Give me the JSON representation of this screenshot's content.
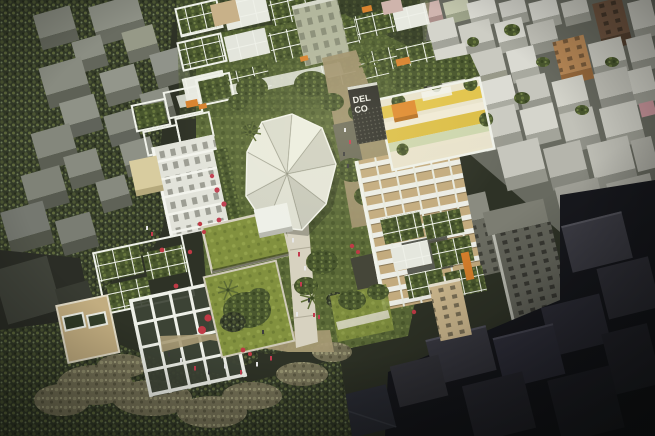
{
  "meta": {
    "title": "Aerial 3D architectural rendering of a green courtyard housing development surrounded by city-block massing",
    "type": "architectural-render",
    "width": 655,
    "height": 436
  },
  "signage": {
    "line1": "DEL",
    "line2": "CO",
    "location": "dark wall of east mid-rise building",
    "text_color": "#f0f0e8",
    "background_color": "#30302a"
  },
  "palette": {
    "ground_base": "#2e3226",
    "foliage_dark": "#333a28",
    "foliage_olive": "#49572e",
    "foliage_pale": "#767257",
    "courtyard_grass": "#5a6937",
    "bright_lawn": "#82913f",
    "massing_roof": "#8b8e83",
    "massing_wall": "#60635a",
    "context_white": "#d7d7cf",
    "dark_massing": "#26262c",
    "frame_white": "#eff1e9",
    "canopy_white": "#e2e3d7",
    "path_tan": "#a1946f",
    "walkway_light": "#d7d2c0",
    "accent_orange": "#d8832f",
    "accent_yellow": "#e2c44c",
    "accent_red": "#bf3a45",
    "facade_tan": "#c3ab7e",
    "facade_cream": "#d8cc9f",
    "context_pink": "#d0b5af",
    "context_brown": "#6f5440",
    "context_orange_tan": "#b98957"
  },
  "scene": {
    "description": "High-angle view of a block-scale redevelopment: white scaffolding-like frames over green roof terraces, a faceted white fabric canopy above a central garden courtyard, bright raised lawns, a light pedestrian walkway with people, an east tower with yellow-striped roof deck and tan balcony facade bearing dark signage, all set inside monochrome gray context buildings that fade to near-black at the lower right.",
    "regions": [
      {
        "name": "context-massing-left",
        "description": "Light gray abstract building volumes over dark olive trees, upper left"
      },
      {
        "name": "context-city-top-right",
        "description": "White and gray city buildings with a pink, a brown and an orange-tan facade"
      },
      {
        "name": "context-massing-dark",
        "description": "Very dark gray building volumes in shadow, bottom right"
      },
      {
        "name": "north-terrace-cluster",
        "description": "Grid of white frame modules with roof gardens along the top of the development"
      },
      {
        "name": "west-tower",
        "description": "White grid facade tower with roof frames, cream annex and orange accents"
      },
      {
        "name": "south-building",
        "description": "Building with green roof modules, tan stone base and double-height white frame grid"
      },
      {
        "name": "central-courtyard",
        "description": "Garden courtyard with faceted white canopy, white pavilion, lawns, palms and paths"
      },
      {
        "name": "east-building",
        "description": "Mid-rise with DEL CO signage, tan balcony facade and colorful yellow roof deck"
      },
      {
        "name": "southeast-terraces",
        "description": "Stepping green terraces with beige stair tower and orange accent wall"
      },
      {
        "name": "pedestrian-walkway",
        "description": "Light concrete walkway with tiny figures crossing the south lawn"
      }
    ],
    "people": {
      "count_estimate": 30,
      "figure_colors": [
        "#e6e6e6",
        "#c23b4e",
        "#3d3d3d"
      ]
    },
    "vegetation": {
      "types": [
        "street trees",
        "roof gardens",
        "palm trees",
        "red flowering shrubs"
      ],
      "umbrella_color": "#bf3a45"
    }
  }
}
